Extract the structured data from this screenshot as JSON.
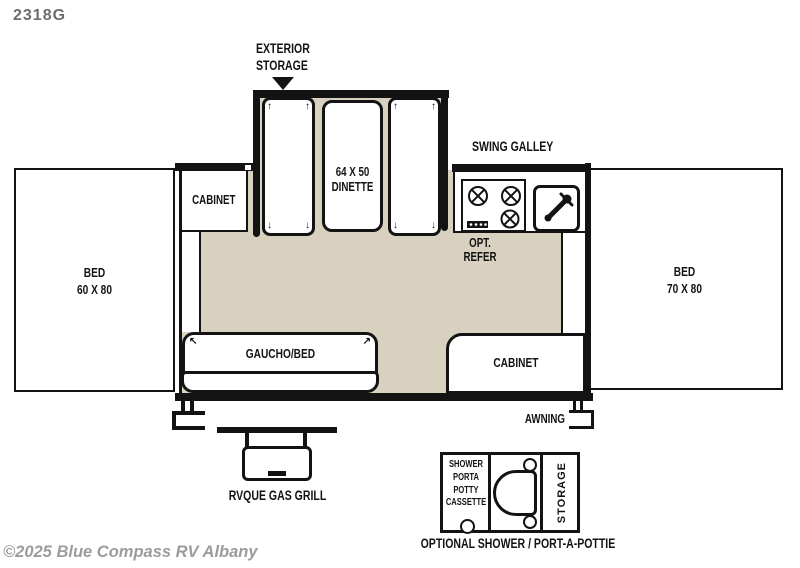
{
  "plan": {
    "model": "2318G",
    "watermark": "©2025 Blue Compass RV Albany",
    "exterior_storage_line1": "EXTERIOR",
    "exterior_storage_line2": "STORAGE",
    "swing_galley": "SWING GALLEY",
    "dinette_line1": "64 X 50",
    "dinette_line2": "DINETTE",
    "cabinet_top": "CABINET",
    "opt_refer_line1": "OPT.",
    "opt_refer_line2": "REFER",
    "bed_left_line1": "BED",
    "bed_left_line2": "60 X 80",
    "bed_right_line1": "BED",
    "bed_right_line2": "70 X 80",
    "gaucho": "GAUCHO/BED",
    "cabinet_bottom": "CABINET",
    "awning": "AWNING",
    "grill": "RVQUE GAS GRILL",
    "shower_lines": [
      "SHOWER",
      "PORTA",
      "POTTY",
      "CASSETTE"
    ],
    "storage_vertical": "STORAGE",
    "optional_label": "OPTIONAL SHOWER / PORT-A-POTTIE"
  },
  "icons": {
    "fold_arrow_up": "↑",
    "fold_arrow_down": "↓",
    "fold_arrow_up_left": "↖",
    "fold_arrow_up_right": "↗"
  },
  "colors": {
    "floor": "#d8d1bf",
    "line": "#131313",
    "model_text": "#6a6e71",
    "watermark_text": "#9c9c9c"
  }
}
